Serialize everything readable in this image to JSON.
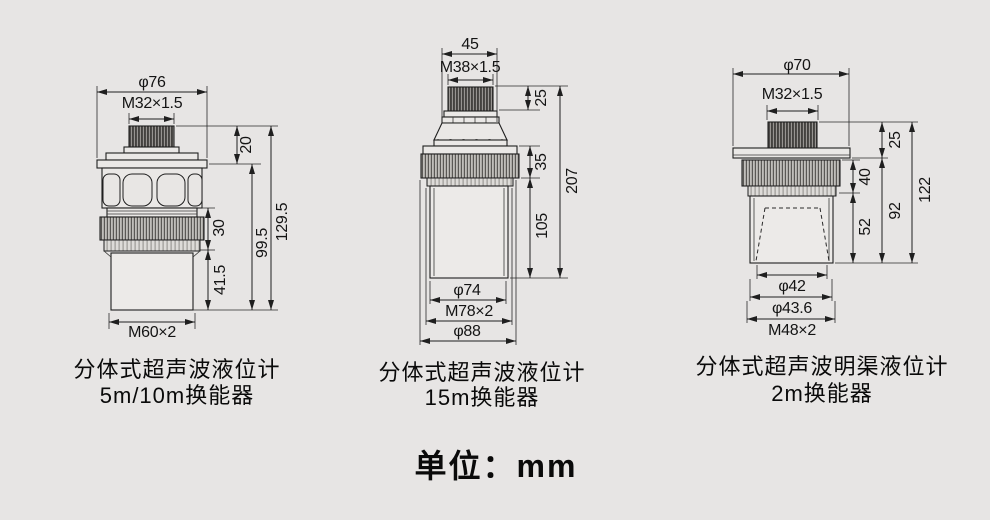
{
  "figures": [
    {
      "dims": {
        "dia_top": "φ76",
        "thread_top": "M32×1.5",
        "cap_h": "20",
        "ring_h": "30",
        "lower_h": "41.5",
        "mid_h": "99.5",
        "total_h": "129.5",
        "thread_bottom": "M60×2"
      },
      "caption_line1": "分体式超声波液位计",
      "caption_line2": "5m/10m换能器"
    },
    {
      "dims": {
        "top_width": "45",
        "thread_top": "M38×1.5",
        "cap_h": "25",
        "ring_h": "35",
        "lower_h": "105",
        "total_h": "207",
        "dia_body": "φ74",
        "thread_bottom": "M78×2",
        "dia_outer": "φ88"
      },
      "caption_line1": "分体式超声波液位计",
      "caption_line2": "15m换能器"
    },
    {
      "dims": {
        "dia_top": "φ70",
        "thread_top": "M32×1.5",
        "cap_h": "25",
        "ring_h": "40",
        "horn_h": "52",
        "mid_h": "92",
        "total_h": "122",
        "dia_horn": "φ42",
        "dia_inner": "φ43.6",
        "thread_bottom": "M48×2"
      },
      "caption_line1": "分体式超声波明渠液位计",
      "caption_line2": "2m换能器"
    }
  ],
  "unit_label": "单位：mm",
  "colors": {
    "background": "#e7e5e4",
    "line": "#1f1f1f"
  }
}
